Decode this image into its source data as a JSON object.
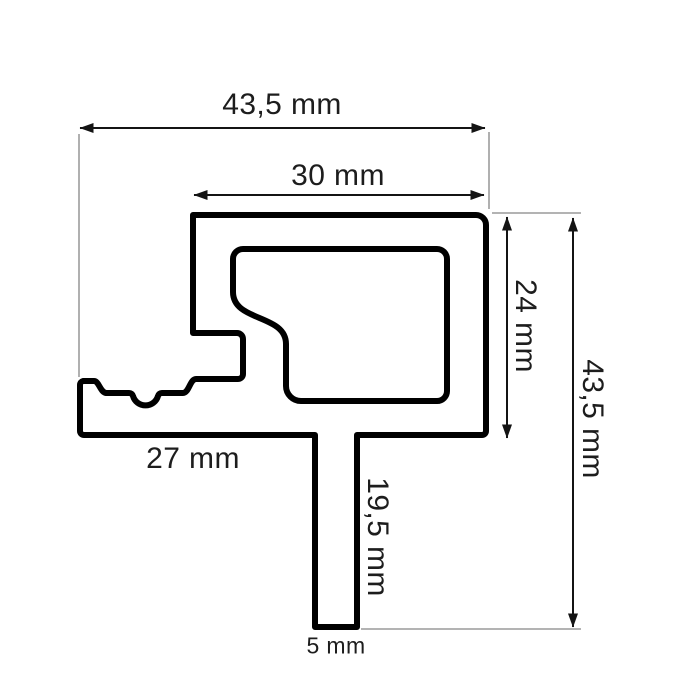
{
  "drawing": {
    "type": "technical-profile-cross-section",
    "unit": "mm",
    "colors": {
      "background": "#ffffff",
      "profile_outline": "#000000",
      "dimension_line": "#141414",
      "extension_line": "#a8a8a8",
      "label_text": "#1d1d1d"
    },
    "dimensions": {
      "overall_width": {
        "label": "43,5 mm",
        "value": 43.5,
        "orientation": "horizontal"
      },
      "top_width": {
        "label": "30 mm",
        "value": 30,
        "orientation": "horizontal"
      },
      "body_height": {
        "label": "24 mm",
        "value": 24,
        "orientation": "vertical"
      },
      "overall_height": {
        "label": "43,5 mm",
        "value": 43.5,
        "orientation": "vertical"
      },
      "base_width": {
        "label": "27 mm",
        "value": 27,
        "orientation": "horizontal"
      },
      "stem_height": {
        "label": "19,5 mm",
        "value": 19.5,
        "orientation": "vertical"
      },
      "stem_width": {
        "label": "5 mm",
        "value": 5,
        "orientation": "horizontal"
      }
    }
  }
}
